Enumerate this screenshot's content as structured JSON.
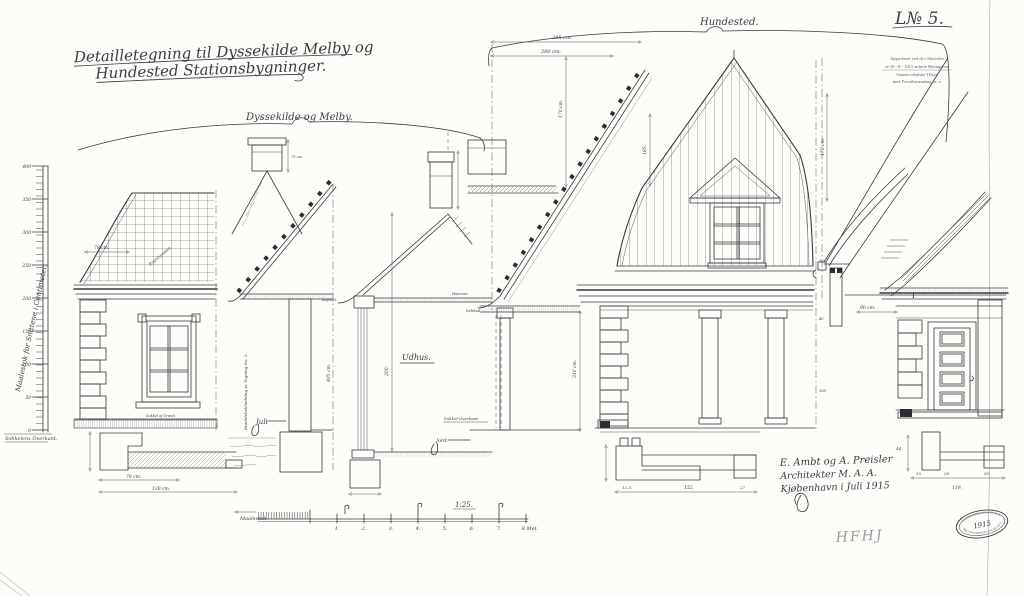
{
  "title": {
    "line1": "Detailletegning til Dyssekilde Melby og",
    "line2": "Hundested Stationsbygninger."
  },
  "groups": {
    "left_label": "Dyssekilde og Melby.",
    "right_label": "Hundested.",
    "litra": "L№ 5."
  },
  "approval": {
    "line1": "Approberet ved de i Skrivelse",
    "line2": "af 16 - 8 - 1915 anførte Betingelser",
    "line3": "Statens tekniske Tilsyn",
    "line4": "med Privatbaneanlæg m. v."
  },
  "ruler": {
    "side_label": "Maalestok for Snittene i Centimeter.",
    "base_label": "Sokkelens Overkant.",
    "ticks": [
      "400",
      "350",
      "300",
      "250",
      "200",
      "150",
      "100",
      "50",
      "0"
    ]
  },
  "labels": {
    "rygning": "Rygningssten.",
    "sokkel_granit": "Sokkel af Granit.",
    "braedde": "Bræddebeklædning se Tegning No. 3.",
    "juli": "Juli",
    "udhus": "Udhus.",
    "kapitael": "Kapitæl.",
    "hammer": "Hammer.",
    "indskud": "Indskud.",
    "sokkel_overkant": "Sokkel-Overkant.",
    "jord": "Jord.",
    "beam_mark": "I"
  },
  "dims": {
    "d78a": "78 cm.",
    "d78b": "78 cm.",
    "d130": "130 cm.",
    "d70": "70 cm.",
    "d405": "405 cm.",
    "d345": "345 cm.",
    "d280": "280 cm.",
    "d170": "170 cm.",
    "d185": "185.",
    "d200": "200.",
    "d310": "310 cm.",
    "d170b": "170 cm.",
    "d90": "90 cm.",
    "d119": "119.",
    "d28": "28.",
    "d50": "50.",
    "d15": "15.",
    "d44": "44.",
    "d152": "152.",
    "d27": "27.",
    "d125": "12,5.",
    "g56": "56.",
    "g40": "40.",
    "g109": "109."
  },
  "scalebar": {
    "left_note": "Maalestok",
    "ratio": "1:25.",
    "ticks": [
      "1.",
      "2.",
      "3.",
      "4.",
      "5.",
      "6.",
      "7.",
      "8 Met."
    ]
  },
  "signature": {
    "line1": "E. Ambt og A. Preisler",
    "line2": "Architekter M. A. A.",
    "line3": "Kjøbenhavn i Juli 1915"
  },
  "stamp": {
    "arc_top": "STATENS TEKNISKE TILSYN",
    "center": "1915",
    "arc_bottom": "MED PRIVATBANEANLÆG M. V."
  },
  "pencil_note": "HFHJ"
}
